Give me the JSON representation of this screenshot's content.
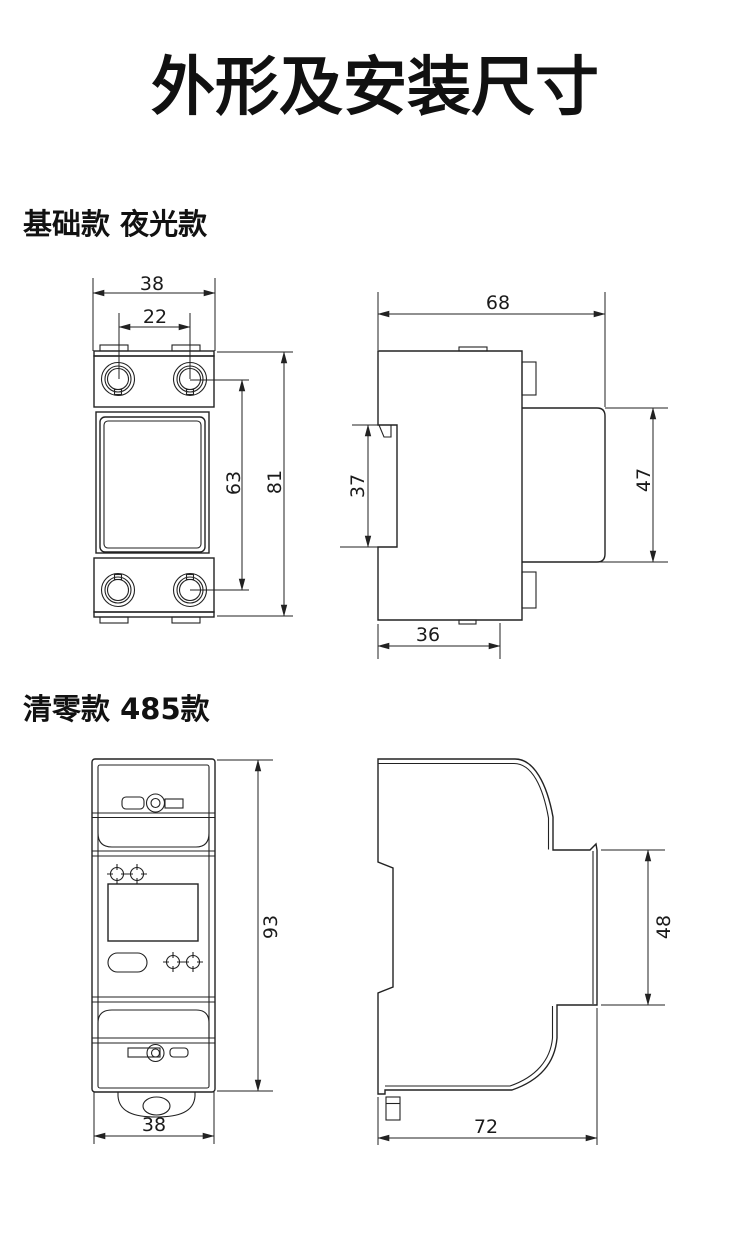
{
  "colors": {
    "background": "#ffffff",
    "line": "#222222",
    "text": "#111111"
  },
  "page_title": "外形及安装尺寸",
  "sections": {
    "basic": {
      "label": "基础款 夜光款",
      "front": {
        "overall_width": "38",
        "terminal_pitch": "22",
        "terminal_span": "63",
        "overall_height": "81"
      },
      "side": {
        "overall_depth": "68",
        "rail_slot_height": "37",
        "front_block_height": "47",
        "base_depth": "36"
      }
    },
    "reset485": {
      "label": "清零款 485款",
      "front": {
        "overall_height": "93",
        "overall_width": "38"
      },
      "side": {
        "front_block_height": "48",
        "overall_depth": "72"
      }
    }
  }
}
